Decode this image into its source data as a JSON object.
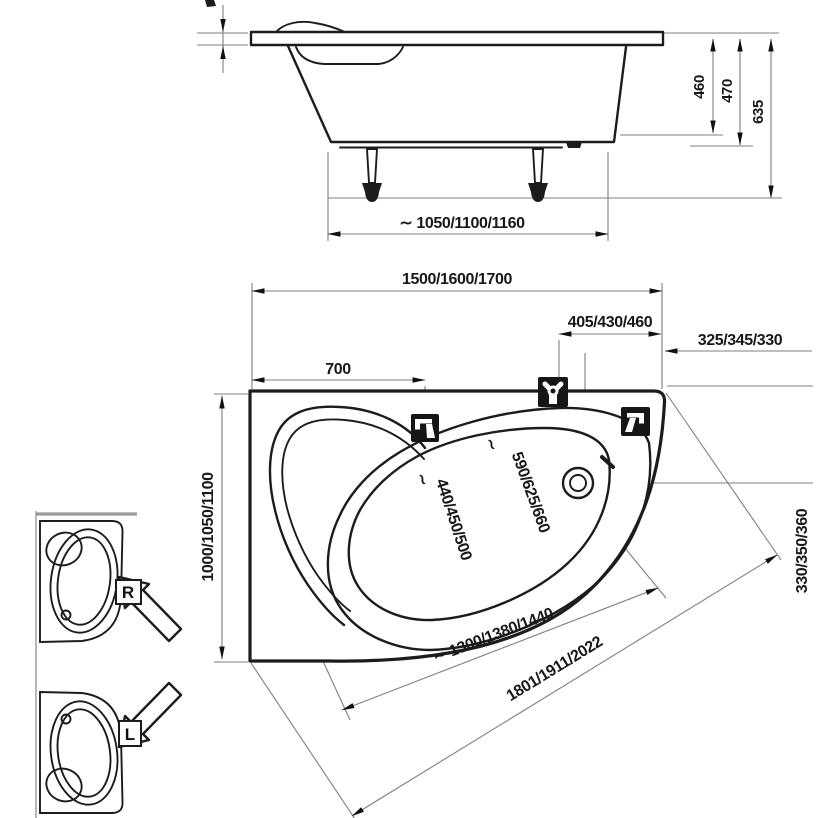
{
  "drawing": {
    "side_view": {
      "height_rim": "460",
      "height_overflow": "470",
      "height_total": "635",
      "feet_span": "∼ 1050/1100/1160"
    },
    "plan_view": {
      "length": "1500/1600/1700",
      "tap_offset": "405/430/460",
      "corner_offset": "325/345/330",
      "left_offset": "700",
      "width": "1000/1050/1100",
      "drain_offset": "330/350/360",
      "inner_width": "440/450/500",
      "rim_width": "590/625/660",
      "inner_length": "∼ 1300/1380/1440",
      "diagonal": "1801/1911/2022",
      "break_mark": "∼"
    },
    "orientation": {
      "right": "R",
      "left": "L"
    },
    "colors": {
      "line": "#1c1c1c",
      "dim_line": "#7f7f7f",
      "icon_bg": "#161616",
      "text": "#181818",
      "background": "#ffffff"
    }
  }
}
